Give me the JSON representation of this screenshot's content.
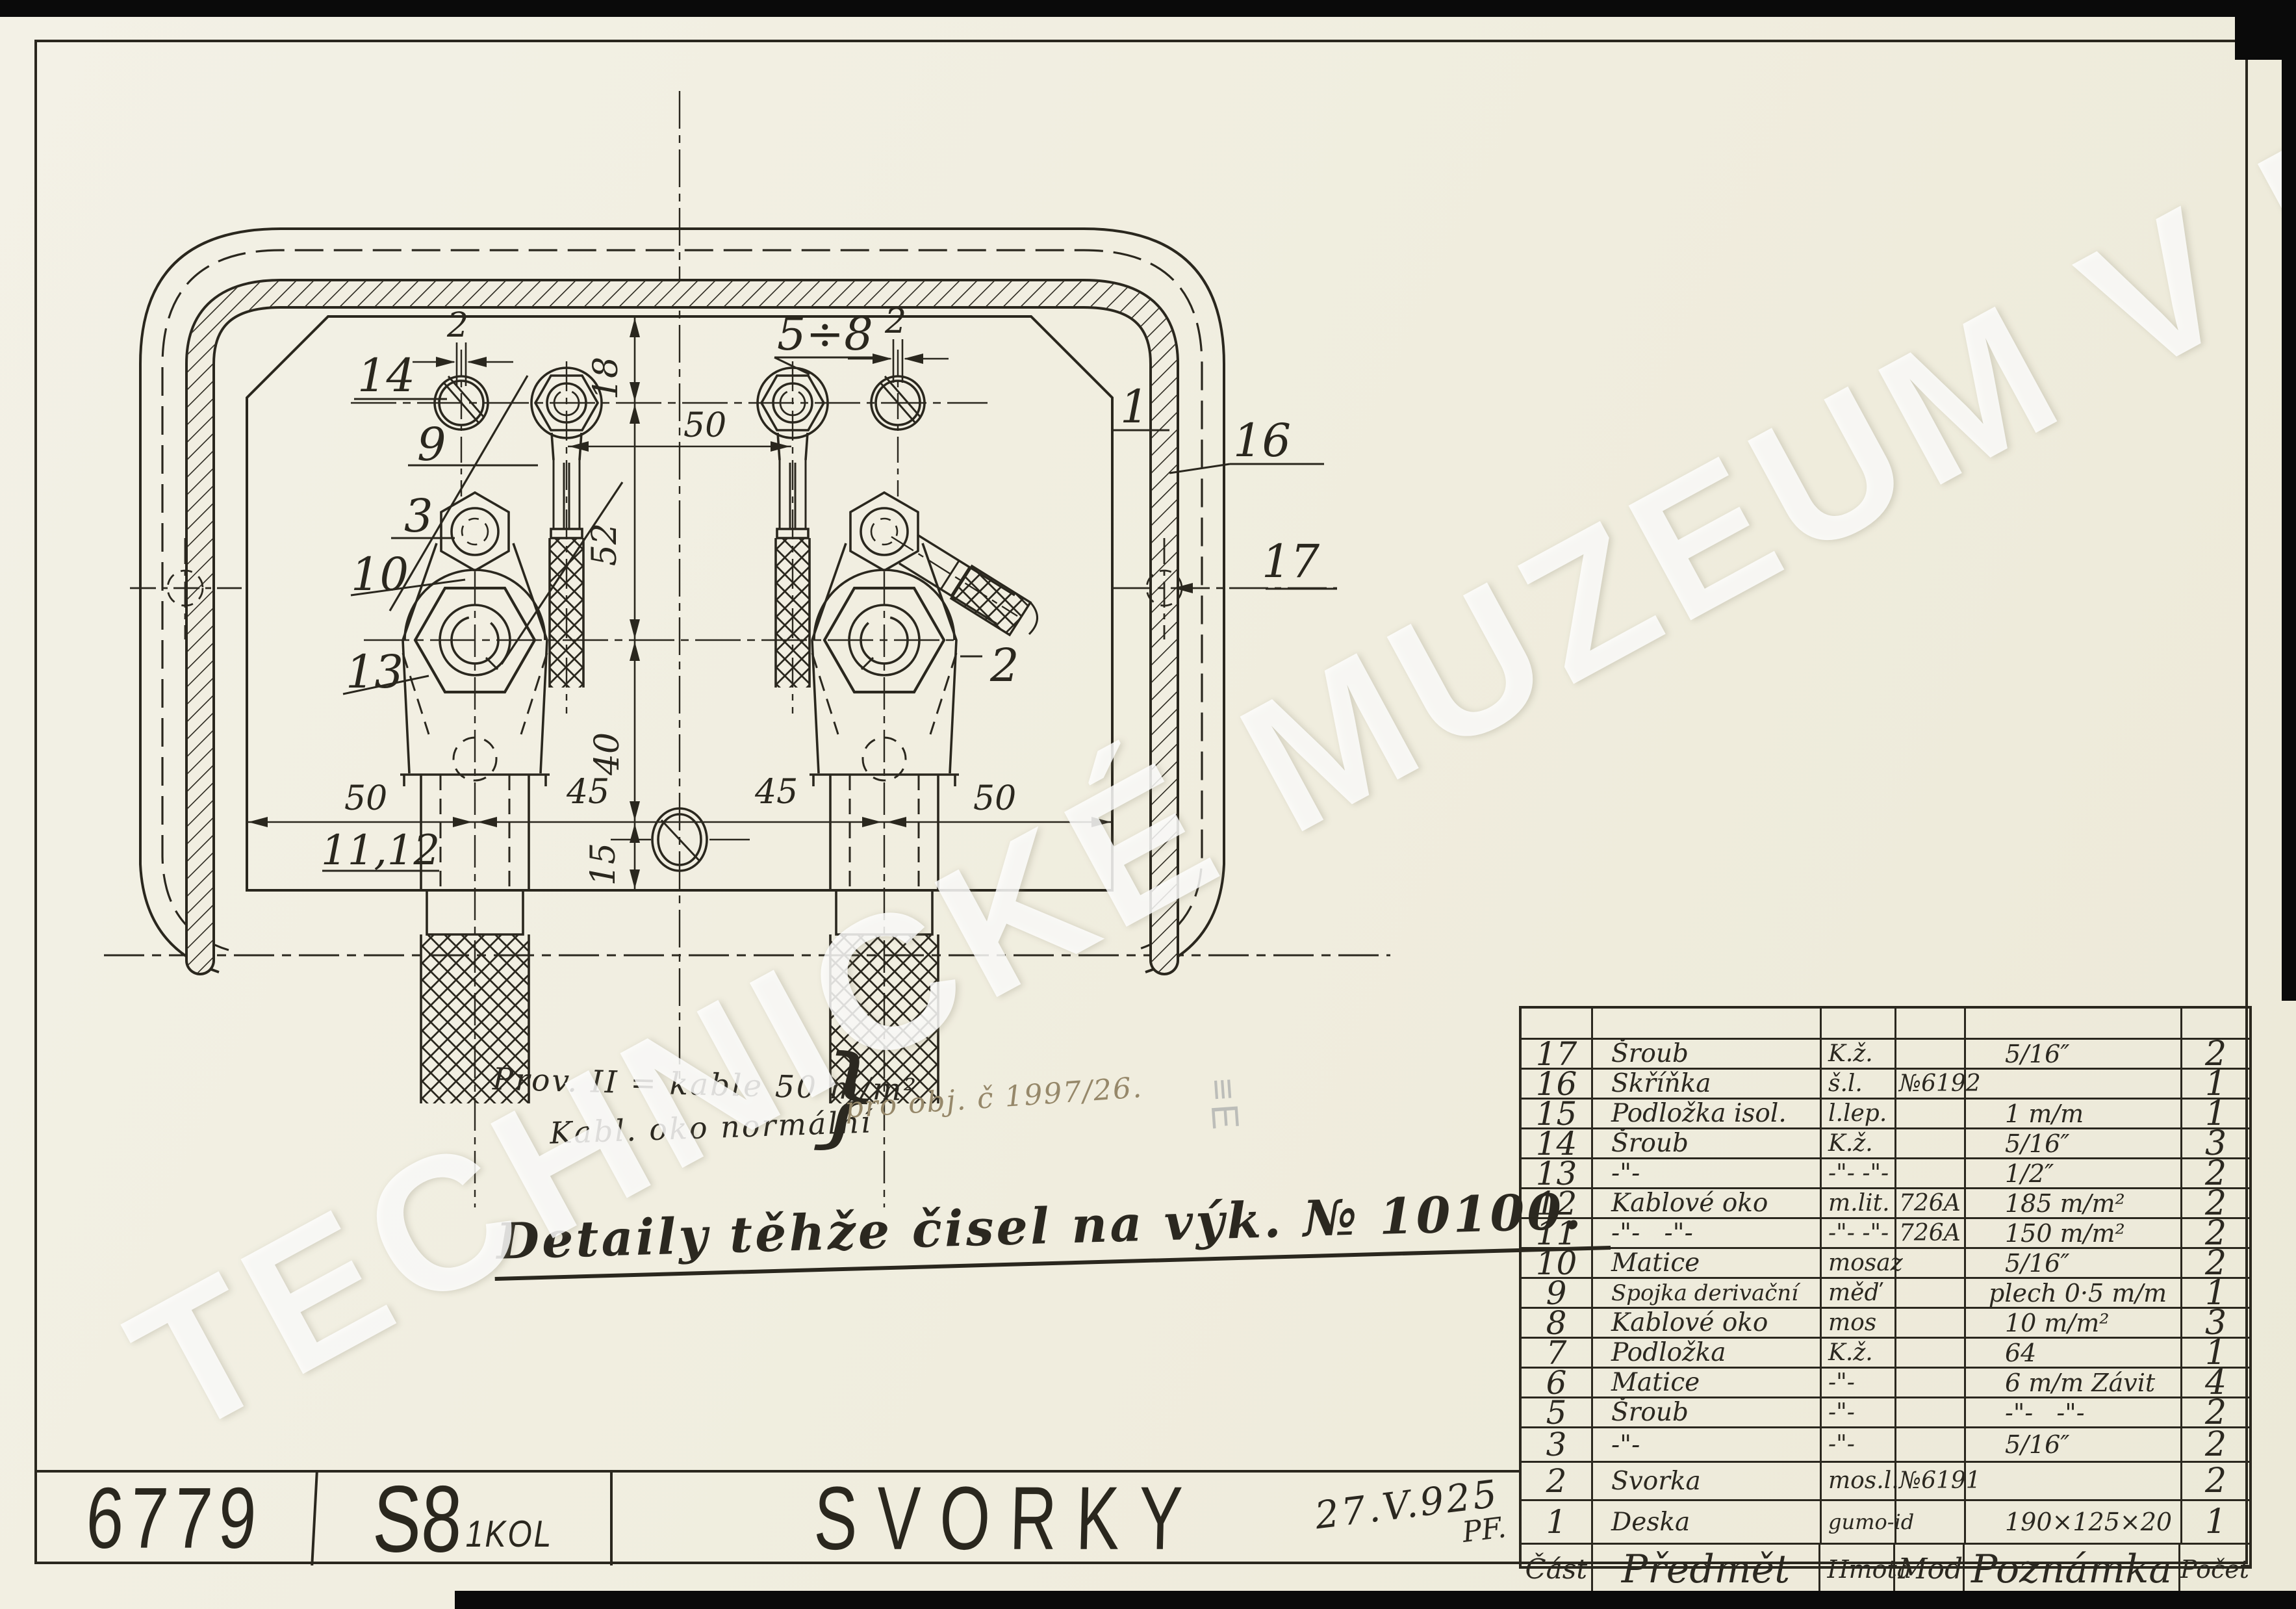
{
  "watermark": {
    "text": "TECHNICKÉ MUZEUM V BRNĚ"
  },
  "title_block": {
    "drawing_number": "6779",
    "series": "S8",
    "series_sub": "1KOL",
    "title": "SVORKY",
    "date": "27.V.925",
    "initials": "PF."
  },
  "notes": {
    "prov_line1": "Prov. II = kable 50 m/m²",
    "prov_line2": "Kabl. oko normální",
    "brace": "}",
    "order_note": "pro obj. č 1997/26.",
    "detail_note": "Detaily těhže čisel na výk. № 10100.",
    "stamp_artifact": "≡E"
  },
  "drawing": {
    "callouts": {
      "c14": "14",
      "c9": "9",
      "c3": "3",
      "c10": "10",
      "c13": "13",
      "c11_12": "11,12",
      "c5_8": "5÷8",
      "c2": "2",
      "c1": "1",
      "c16": "16",
      "c17": "17"
    },
    "dims": {
      "d2_left": "2",
      "d2_right": "2",
      "d18": "18",
      "d50_top": "50",
      "d52": "52",
      "d40": "40",
      "d15": "15",
      "d50_bl": "50",
      "d45_l": "45",
      "d45_r": "45",
      "d50_br": "50"
    }
  },
  "parts_table": {
    "headers": {
      "cast": "Část",
      "predmet": "Předmět",
      "hmota": "Hmota",
      "mod": "Mod",
      "poznamka": "Poznámka",
      "pocet": "Počet"
    },
    "rows": [
      {
        "cast": "17",
        "predmet": "Šroub",
        "hmota": "K.ž.",
        "mod": "",
        "poznamka": "5/16″",
        "pocet": "2"
      },
      {
        "cast": "16",
        "predmet": "Skříňka",
        "hmota": "š.l.",
        "mod": "№6192",
        "poznamka": "",
        "pocet": "1"
      },
      {
        "cast": "15",
        "predmet": "Podložka isol.",
        "hmota": "l.lep.",
        "mod": "",
        "poznamka": "1 m/m",
        "pocet": "1"
      },
      {
        "cast": "14",
        "predmet": "Šroub",
        "hmota": "K.ž.",
        "mod": "",
        "poznamka": "5/16″",
        "pocet": "3"
      },
      {
        "cast": "13",
        "predmet": "-\"-",
        "hmota": "-\"- -\"-",
        "mod": "",
        "poznamka": "1/2″",
        "pocet": "2"
      },
      {
        "cast": "12",
        "predmet": "Kablové oko",
        "hmota": "m.lit.",
        "mod": "726A",
        "poznamka": "185 m/m²",
        "pocet": "2"
      },
      {
        "cast": "11",
        "predmet": "-\"-   -\"-",
        "hmota": "-\"- -\"-",
        "mod": "726A",
        "poznamka": "150 m/m²",
        "pocet": "2"
      },
      {
        "cast": "10",
        "predmet": "Matice",
        "hmota": "mosaz",
        "mod": "",
        "poznamka": "5/16″",
        "pocet": "2"
      },
      {
        "cast": "9",
        "predmet": "Spojka derivační",
        "hmota": "měď",
        "mod": "",
        "poznamka": "plech 0·5 m/m",
        "pocet": "1"
      },
      {
        "cast": "8",
        "predmet": "Kablové oko",
        "hmota": "mos",
        "mod": "",
        "poznamka": "10 m/m²",
        "pocet": "3"
      },
      {
        "cast": "7",
        "predmet": "Podložka",
        "hmota": "K.ž.",
        "mod": "",
        "poznamka": "64",
        "pocet": "1"
      },
      {
        "cast": "6",
        "predmet": "Matice",
        "hmota": "-\"-",
        "mod": "",
        "poznamka": "6 m/m Závit",
        "pocet": "4"
      },
      {
        "cast": "5",
        "predmet": "Šroub",
        "hmota": "-\"-",
        "mod": "",
        "poznamka": "-\"-   -\"-",
        "pocet": "2"
      },
      {
        "cast": "3",
        "predmet": "-\"-",
        "hmota": "-\"-",
        "mod": "",
        "poznamka": "5/16″",
        "pocet": "2"
      },
      {
        "cast": "2",
        "predmet": "Svorka",
        "hmota": "mos.l.",
        "mod": "№6191",
        "poznamka": "",
        "pocet": "2"
      },
      {
        "cast": "1",
        "predmet": "Deska",
        "hmota": "gumo-id",
        "mod": "",
        "poznamka": "190×125×20",
        "pocet": "1"
      }
    ]
  },
  "colors": {
    "paper": "#f1eee1",
    "ink": "#2a271e"
  }
}
